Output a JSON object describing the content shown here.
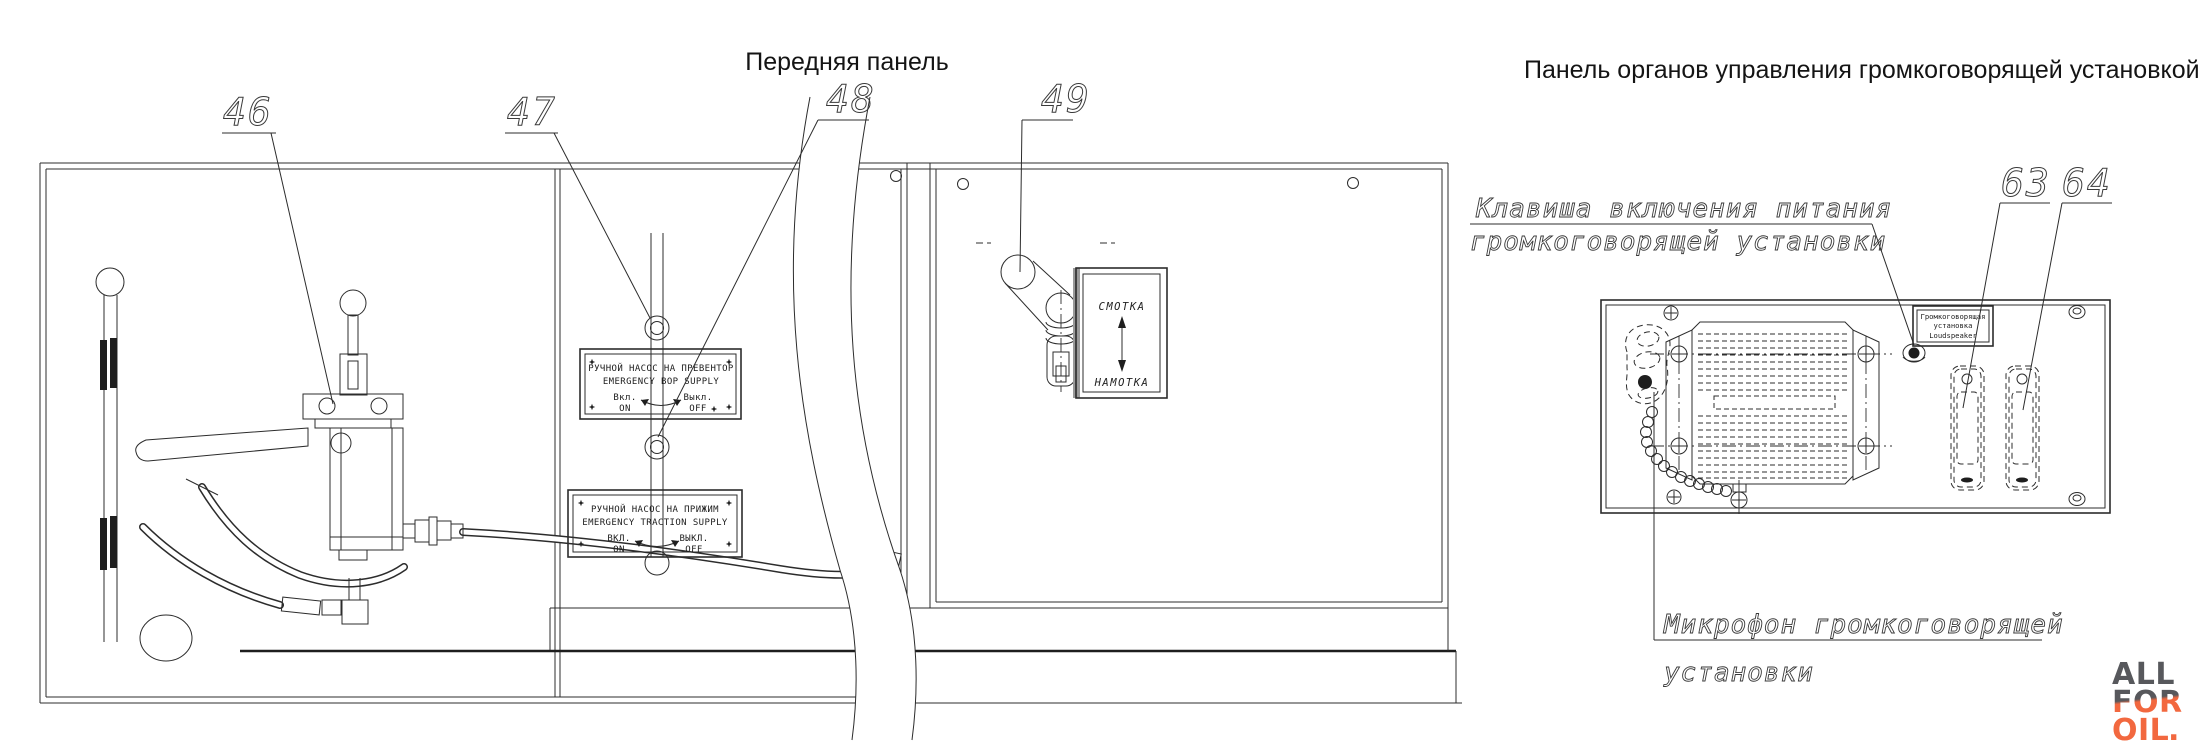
{
  "titles": {
    "front_panel": "Передняя панель",
    "speaker_panel": "Панель органов управления громкоговорящей установкой"
  },
  "callouts": {
    "n46": "46",
    "n47": "47",
    "n48": "48",
    "n49": "49",
    "n63": "63",
    "n64": "64"
  },
  "plates": {
    "bop_pump": {
      "title_ru": "РУЧНОЙ НАСОС НА ПРЕВЕНТОР",
      "title_en": "EMERGENCY BOP SUPPLY",
      "on_ru": "Вкл.",
      "on_en": "ON",
      "off_ru": "Выкл.",
      "off_en": "OFF"
    },
    "traction_pump": {
      "title_ru": "РУЧНОЙ НАСОС НА ПРИЖИМ",
      "title_en": "EMERGENCY TRACTION SUPPLY",
      "on_ru": "ВКЛ.",
      "on_en": "ON",
      "off_ru": "ВЫКЛ.",
      "off_en": "OFF"
    },
    "cable_reel": {
      "up": "СМОТКА",
      "down": "НАМОТКА"
    },
    "loudspeaker": {
      "line1": "Громкоговорящая",
      "line2": "установка",
      "line3": "Loudspeaker"
    }
  },
  "annotations": {
    "power_key_line1": "Клавиша включения питания",
    "power_key_line2": "громкоговорящей установки",
    "microphone_line1": "Микрофон громкоговорящей",
    "microphone_line2": "установки"
  },
  "logo": {
    "word1": "ALL",
    "word2": "FOR",
    "word3": "OIL",
    "dot": ".",
    "gray": "#57585c",
    "orange": "#f2683f"
  },
  "colors": {
    "line": "#2c2c2c",
    "background": "#ffffff"
  }
}
